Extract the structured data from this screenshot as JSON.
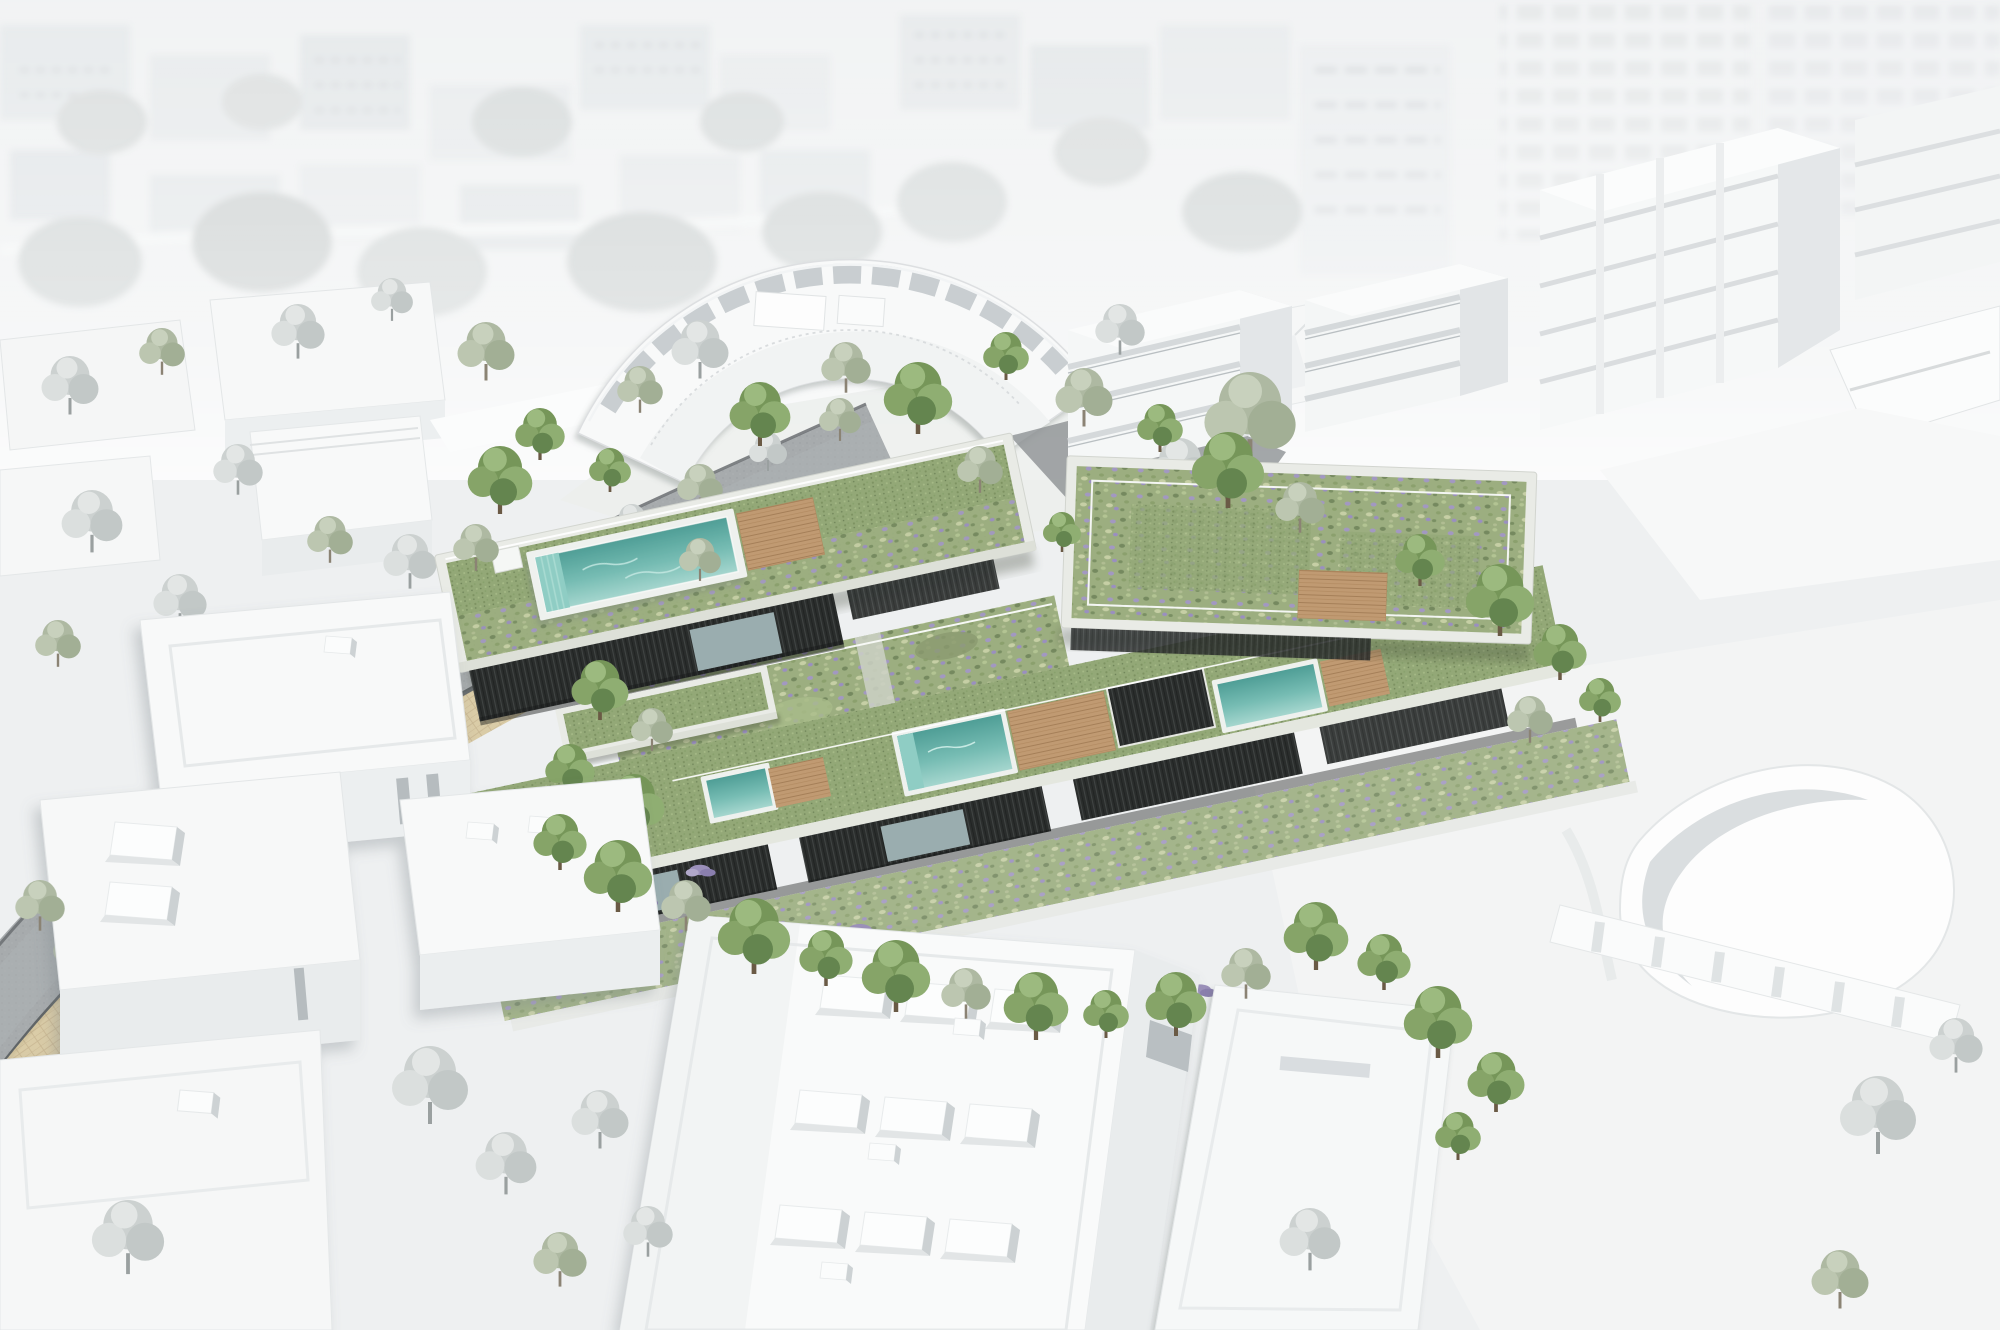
{
  "scene": {
    "kind": "aerial architectural rendering",
    "subject": "terraced housing development with planted green roofs, rooftop pools and timber decks, shown in color against a desaturated white city model",
    "visible_text": []
  },
  "palette": {
    "background": "#eef0f1",
    "massing_white": "#f8f9f9",
    "massing_shade": "#e4e7e9",
    "photo_city_gray": "#e0e4e6",
    "road_asphalt": "#a7abad",
    "road_wall_dark": "#595d5f",
    "sidewalk_paving": "#d8c9a2",
    "green_roof": "#93a877",
    "meadow": "#9cae80",
    "pool_deep": "#4f9e96",
    "pool_mid": "#76bcb3",
    "pool_light": "#a5d6ce",
    "wood_deck": "#c09a72",
    "dark_facade": "#2a2d2c",
    "glass": "#9aadaf",
    "parapet": "#e9ebe6",
    "corten": "#8f5c35",
    "tree_green": "#769659",
    "tree_sage": "#aeb9a2",
    "tree_gray": "#ccd1d0",
    "shrub_purple": "#9b90ba"
  }
}
